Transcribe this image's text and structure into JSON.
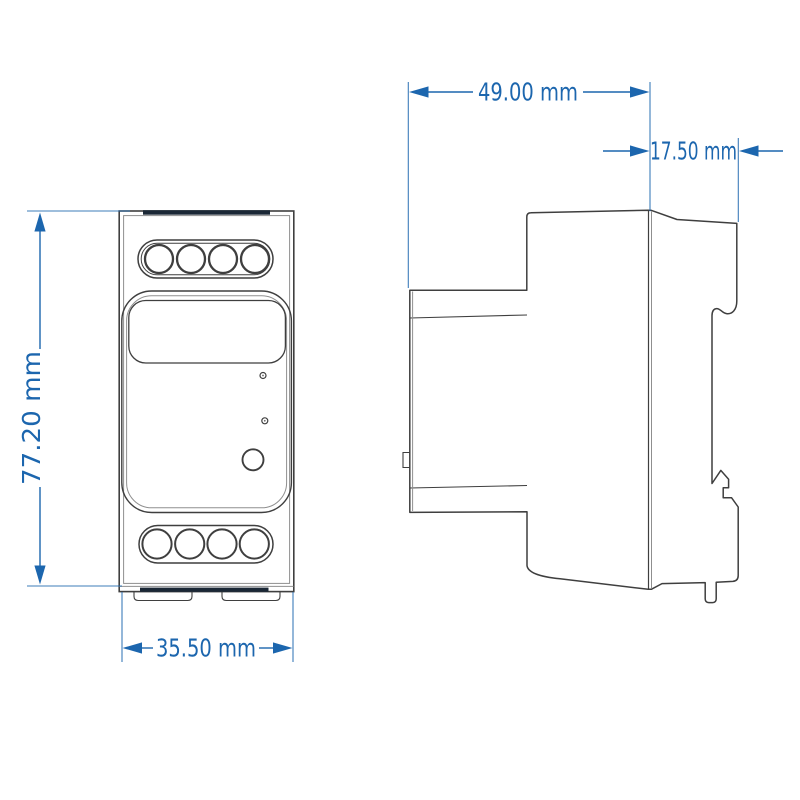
{
  "drawing": {
    "type": "technical-drawing",
    "unit": "mm",
    "dimensions": {
      "height": {
        "label": "77.20 mm",
        "value": 77.2
      },
      "width": {
        "label": "35.50 mm",
        "value": 35.5
      },
      "depth": {
        "label": "49.00 mm",
        "value": 49.0
      },
      "rail_offset": {
        "label": "17.50 mm",
        "value": 17.5
      }
    },
    "views": {
      "front": {
        "terminal_holes_top": 4,
        "terminal_holes_bottom": 4,
        "led_indicators": 2,
        "buttons": 1
      },
      "side": {
        "din_rail_clips": 2
      }
    },
    "colors": {
      "dimension": "#1c66ae",
      "outline": "#3f3f3f",
      "outline-light": "#8f8f8f",
      "accent-bar": "#1b2836",
      "background": "#ffffff"
    }
  }
}
